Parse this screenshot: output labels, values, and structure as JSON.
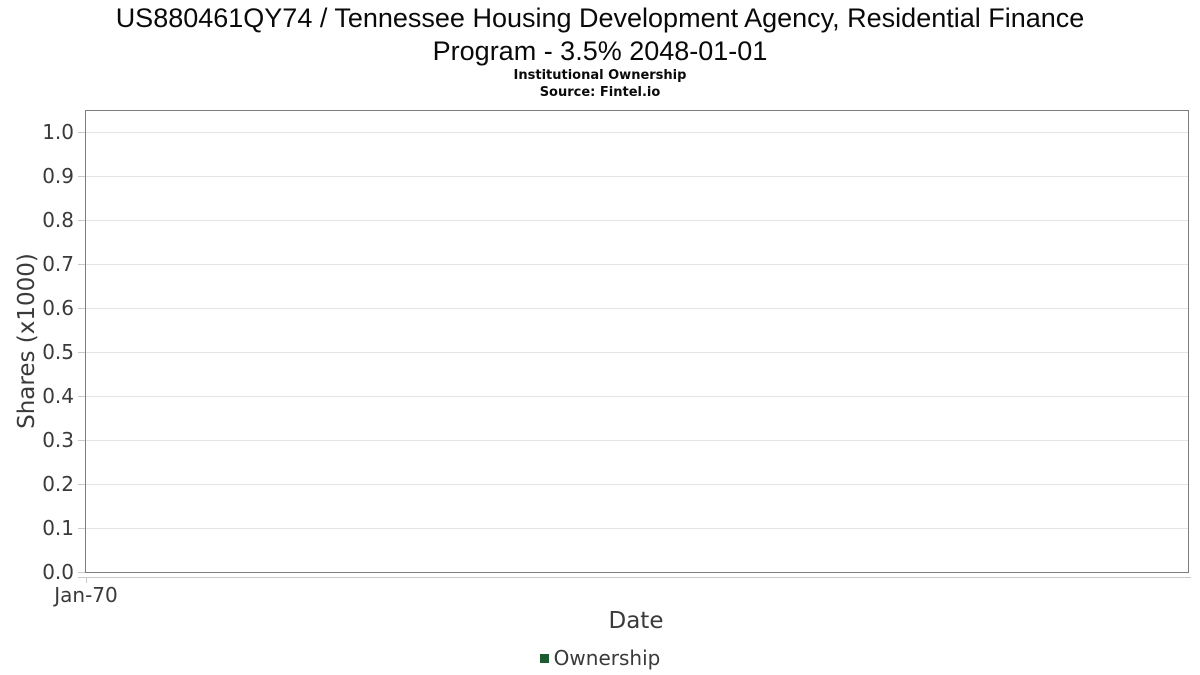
{
  "header": {
    "title_line1": "US880461QY74 / Tennessee Housing Development Agency, Residential Finance",
    "title_line2": "Program - 3.5% 2048-01-01",
    "subtitle": "Institutional Ownership",
    "source": "Source: Fintel.io"
  },
  "chart_data": {
    "type": "line",
    "title": "US880461QY74 / Tennessee Housing Development Agency, Residential Finance Program - 3.5% 2048-01-01",
    "subtitle": "Institutional Ownership",
    "source": "Source: Fintel.io",
    "xlabel": "Date",
    "ylabel": "Shares (x1000)",
    "x_ticks": [
      "Jan-70"
    ],
    "x_tick_fractions": [
      0
    ],
    "y_ticks": [
      0.0,
      0.1,
      0.2,
      0.3,
      0.4,
      0.5,
      0.6,
      0.7,
      0.8,
      0.9,
      1.0
    ],
    "ylim": [
      0,
      1.05
    ],
    "grid": "horizontal",
    "legend_position": "bottom",
    "series": [
      {
        "name": "Ownership",
        "color": "#1d5c30",
        "x": [],
        "values": []
      }
    ],
    "colors": {
      "plot_border": "#7d7d7d",
      "gridline": "#e4e4e4",
      "axis_line": "#c9c9c9",
      "label_text": "#3a3a3a",
      "title_text": "#0a0a0a",
      "legend_marker": "#1d5c30"
    }
  }
}
